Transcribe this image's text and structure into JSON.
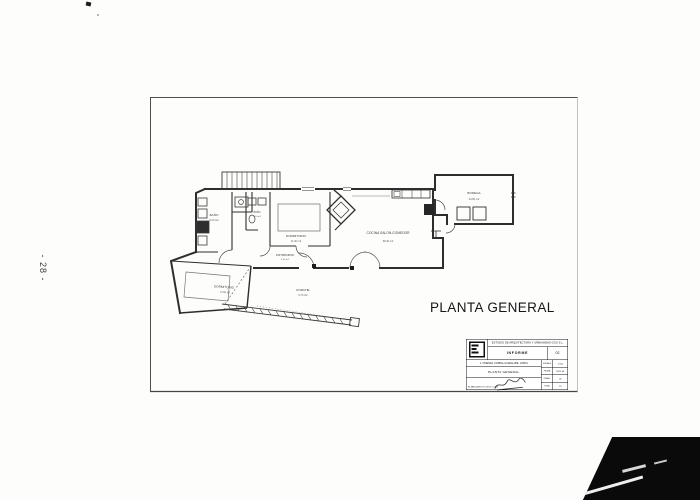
{
  "page": {
    "side_number": "- 28 -",
    "plan_title": "PLANTA GENERAL"
  },
  "plan": {
    "rooms": [
      {
        "name": "BAÑO",
        "area": "5.20 m2"
      },
      {
        "name": "BAÑO",
        "area": "3.10 m2"
      },
      {
        "name": "DORMITORIO",
        "area": "11.30 m2"
      },
      {
        "name": "DISTRIBUIDOR",
        "area": "4.60 m2"
      },
      {
        "name": "COCINA SALON-COMEDOR",
        "area": "38.40 m2"
      },
      {
        "name": "DORMITORIO",
        "area": "13.50 m2"
      },
      {
        "name": "PORCHE",
        "area": "9.70 m2"
      },
      {
        "name": "BODEGA",
        "area": "24.80 m2"
      }
    ]
  },
  "title_block": {
    "firm": "ESTUDIO DE ARQUITECTURA Y URBANISMO GOU S.L.",
    "doc_type": "INFORME",
    "doc_num": "02",
    "project_line": "1. VIVIENDA. CORRAL GUADALUPE. LORCA",
    "sheet_title": "PLANTA GENERAL",
    "fields": [
      {
        "label": "ESCALA",
        "value": "1:100"
      },
      {
        "label": "FECHA",
        "value": "NOV. 04"
      },
      {
        "label": "PLANO",
        "value": "02"
      },
      {
        "label": "HOJA",
        "value": "1/1"
      }
    ],
    "footer_line": "EL ARQUITECTO, NOV. 2.004"
  },
  "colors": {
    "ink": "#2e2e2e",
    "frame": "#4e4e4e",
    "scan_black": "#0a0a0a"
  }
}
